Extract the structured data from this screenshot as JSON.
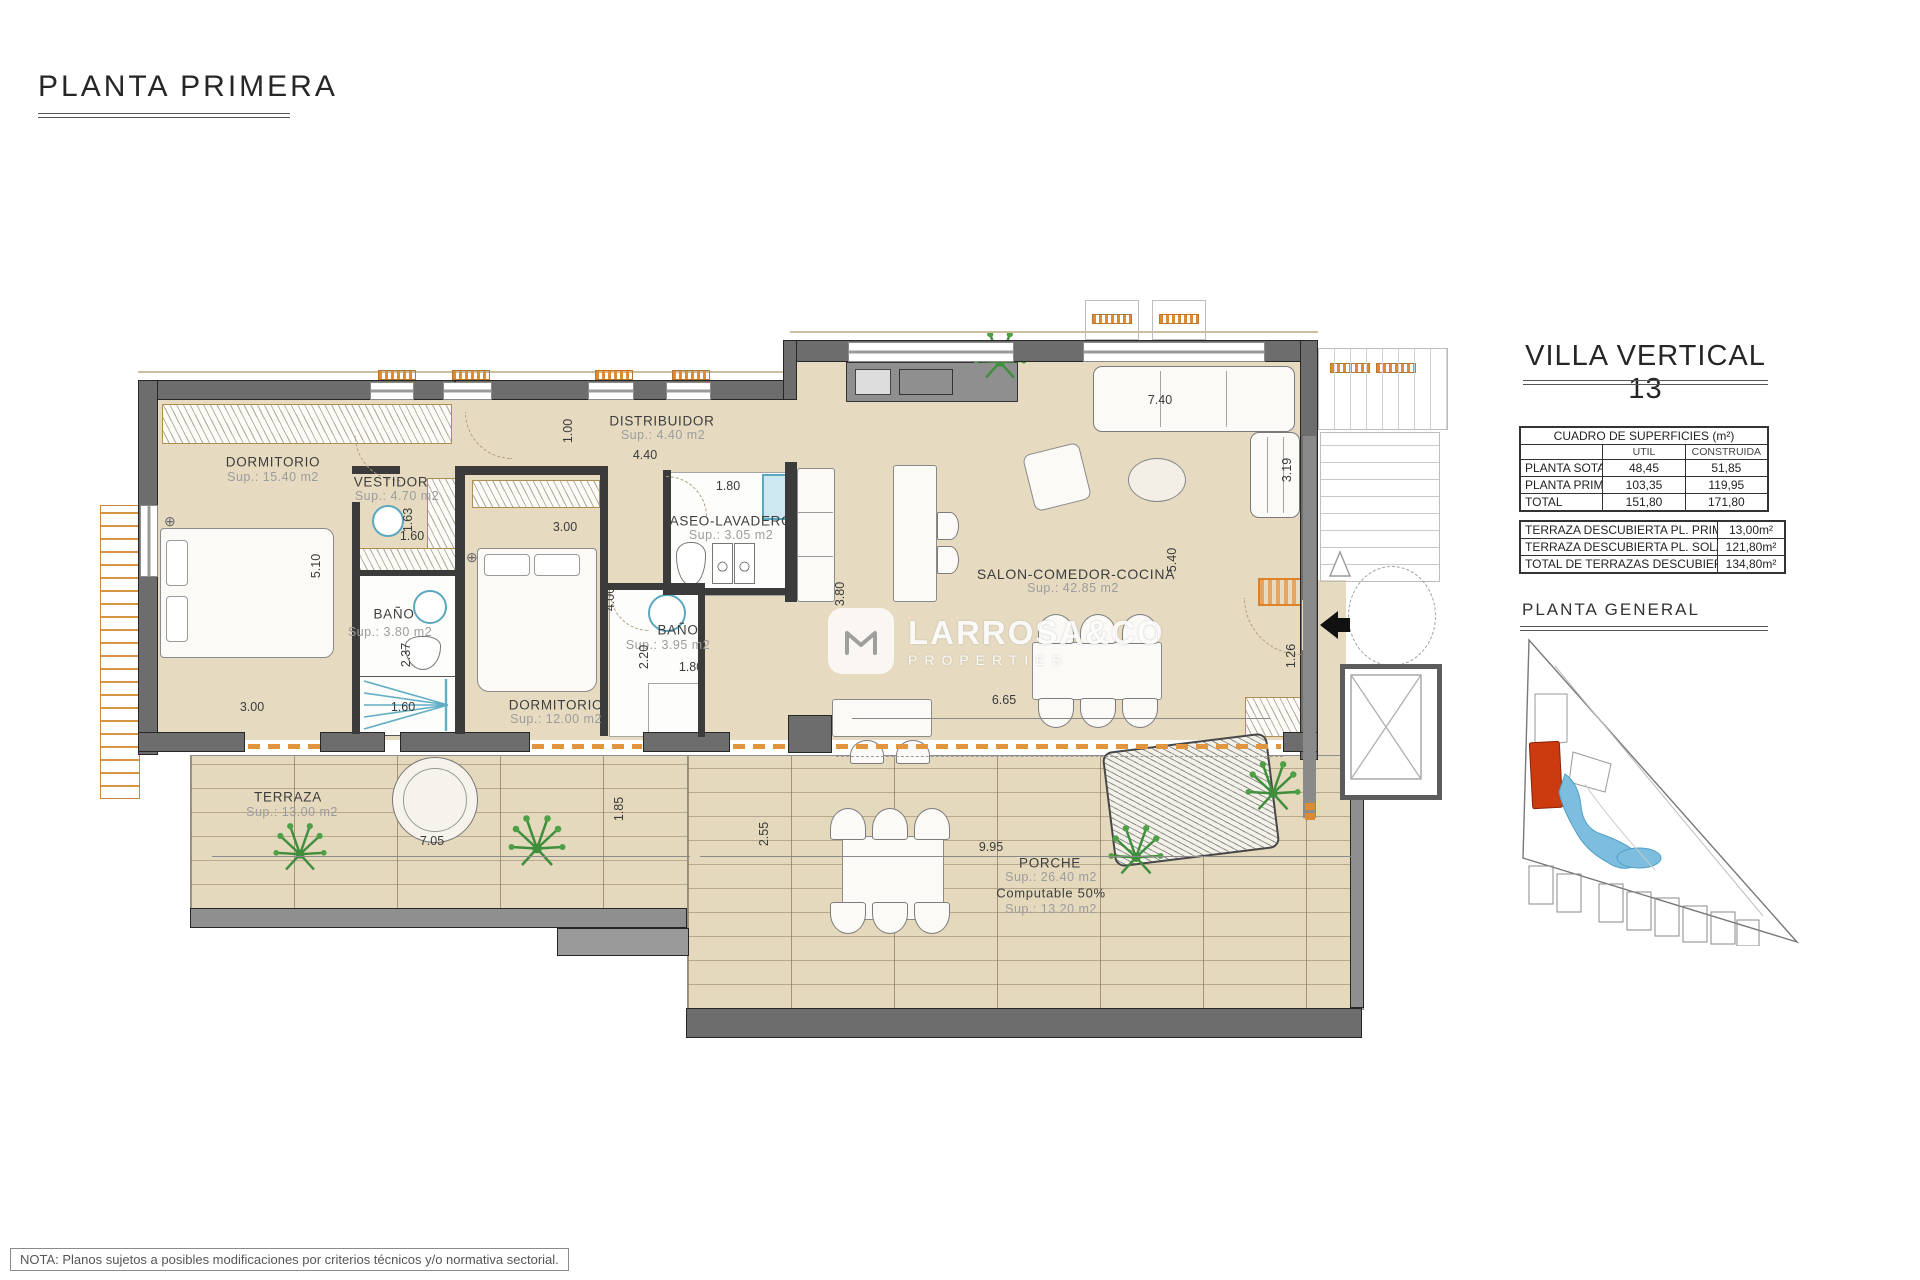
{
  "header": {
    "title": "PLANTA PRIMERA"
  },
  "note": "NOTA: Planos sujetos a posibles modificaciones por criterios técnicos y/o normativa sectorial.",
  "watermark": {
    "name": "LARROSA&CO",
    "tagline": "PROPERTIES"
  },
  "panel": {
    "villa_title": "VILLA VERTICAL 13",
    "surfaces": {
      "title": "CUADRO DE SUPERFICIES (m²)",
      "col_util": "UTIL",
      "col_construida": "CONSTRUIDA",
      "rows": [
        {
          "label": "PLANTA SOTANO",
          "util": "48,45",
          "construida": "51,85"
        },
        {
          "label": "PLANTA PRIMERA",
          "util": "103,35",
          "construida": "119,95"
        },
        {
          "label": "TOTAL",
          "util": "151,80",
          "construida": "171,80"
        }
      ]
    },
    "terraces": {
      "rows": [
        {
          "label": "TERRAZA DESCUBIERTA PL. PRIMERA",
          "value": "13,00m²"
        },
        {
          "label": "TERRAZA DESCUBIERTA PL. SOLARIUM",
          "value": "121,80m²"
        },
        {
          "label": "TOTAL DE TERRAZAS DESCUBIERTAS",
          "value": "134,80m²"
        }
      ]
    },
    "site_title": "PLANTA GENERAL"
  },
  "rooms": {
    "dorm1": {
      "name": "DORMITORIO",
      "sup": "Sup.: 15.40  m2"
    },
    "vestidor": {
      "name": "VESTIDOR",
      "sup": "Sup.: 4.70   m2"
    },
    "distribuidor": {
      "name": "DISTRIBUIDOR",
      "sup": "Sup.: 4.40   m2"
    },
    "bano1": {
      "name": "BAÑO",
      "sup": "Sup.: 3.80   m2"
    },
    "dorm2": {
      "name": "DORMITORIO",
      "sup": "Sup.: 12.00  m2"
    },
    "aseo": {
      "name": "ASEO-LAVADERO",
      "sup": "Sup.: 3.05   m2"
    },
    "bano2": {
      "name": "BAÑO",
      "sup": "Sup.: 3.95  m2"
    },
    "salon": {
      "name": "SALON-COMEDOR-COCINA",
      "sup": "Sup.: 42.85 m2"
    },
    "terraza": {
      "name": "TERRAZA",
      "sup": "Sup.: 13.00 m2"
    },
    "porche": {
      "name": "PORCHE",
      "sup": "Sup.: 26.40 m2",
      "computable": "Computable 50%",
      "sup2": "Sup.: 13.20 m2"
    }
  },
  "dims": {
    "d510": "5.10",
    "d300a": "3.00",
    "d160a": "1.60",
    "d237": "2.37",
    "d163": "1.63",
    "d160b": "1.60",
    "d300b": "3.00",
    "d400": "4.00",
    "d100": "1.00",
    "d440": "4.40",
    "d180a": "1.80",
    "d180b": "1.80",
    "d220": "2.20",
    "d380": "3.80",
    "d740": "7.40",
    "d319": "3.19",
    "d540": "5.40",
    "d126": "1.26",
    "d665": "6.65",
    "d705": "7.05",
    "d185": "1.85",
    "d255": "2.55",
    "d995": "9.95"
  }
}
